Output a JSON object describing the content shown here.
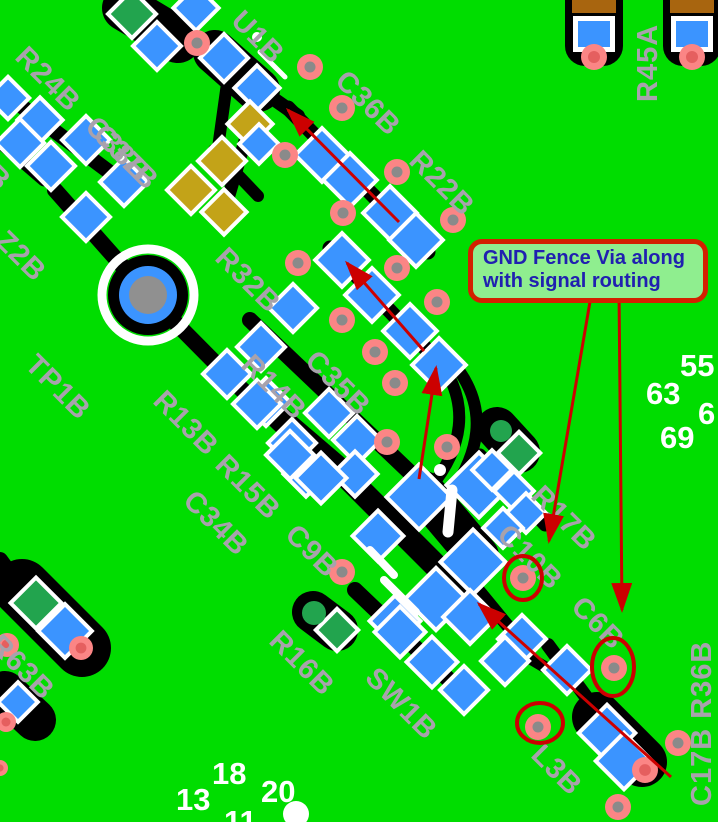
{
  "annotation": {
    "line1": "GND Fence Via along",
    "line2": "with signal routing"
  },
  "designators": {
    "r24b": "R24B",
    "c38b": "C38B",
    "c37b": "C37B",
    "edge3b": "3B",
    "z2b": "Z2B",
    "tp1b": "TP1B",
    "r13b": "R13B",
    "r32b": "R32B",
    "r14b": "R14B",
    "c35b": "C35B",
    "u1b": "U1B",
    "c36b": "C36B",
    "r22b": "R22B",
    "r15b": "R15B",
    "c34b": "C34B",
    "c9b": "C9B",
    "r16b": "R16B",
    "sw1b": "SW1B",
    "r17b": "R17B",
    "c10b": "C10B",
    "c6b": "C6B",
    "l3b": "L3B",
    "r63b": "R63B",
    "c17b_r36b": "C17B R36B",
    "r45a": "R45A"
  },
  "grid_numbers": {
    "n55": "55",
    "n63": "63",
    "n6": "6",
    "n69": "69",
    "n13": "13",
    "n18": "18",
    "n20": "20",
    "n11": "11"
  },
  "colors": {
    "board_green": "#00DD00",
    "pad_blue": "#3B94FF",
    "silkscreen_white": "#FFFFFF",
    "label_gray": "#A8A2AC",
    "via_pink": "#FB8585",
    "via_hole_gray": "#8A8A8A",
    "pad_yellow": "#C3A318",
    "pad_green": "#22A44E",
    "pad_brown": "#A8650F",
    "annotation_red": "#CC0000",
    "callout_fill": "#8FEE8F",
    "callout_border": "#D32000",
    "callout_text": "#2020B0",
    "trace_black": "#000000"
  }
}
